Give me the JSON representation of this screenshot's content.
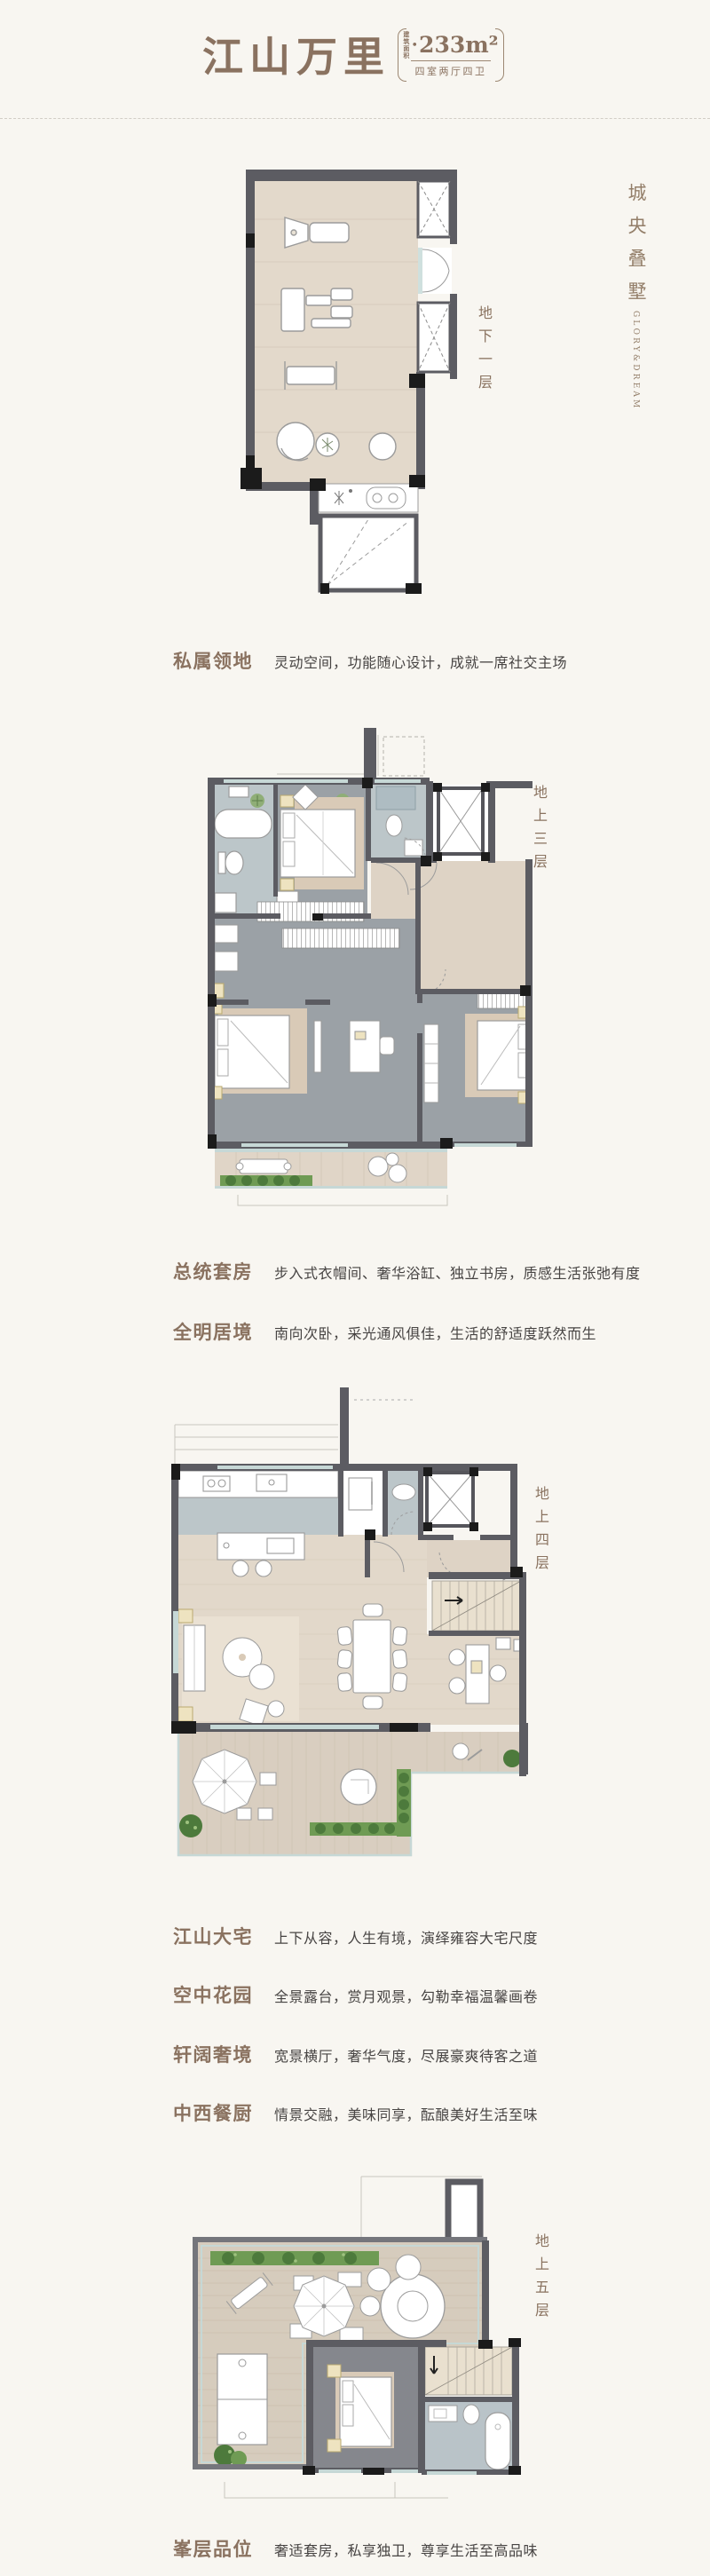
{
  "page": {
    "background": "#f8f6f1"
  },
  "header": {
    "title": "江山万里",
    "area_label_lines": [
      "建筑",
      "面积"
    ],
    "area_bullet": "•",
    "area_value": "233m²",
    "layout": "四室两厅四卫"
  },
  "brand": {
    "cn": "城央叠墅",
    "en": "GLORY&DREAM"
  },
  "floors": [
    {
      "id": "basement",
      "label": "地下一层"
    },
    {
      "id": "floor-3",
      "label": "地上三层"
    },
    {
      "id": "floor-4",
      "label": "地上四层"
    },
    {
      "id": "floor-5",
      "label": "地上五层"
    }
  ],
  "features": [
    {
      "title": "私属领地",
      "desc": "灵动空间，功能随心设计，成就一席社交主场"
    },
    {
      "title": "总统套房",
      "desc": "步入式衣帽间、奢华浴缸、独立书房，质感生活张弛有度"
    },
    {
      "title": "全明居境",
      "desc": "南向次卧，采光通风俱佳，生活的舒适度跃然而生"
    },
    {
      "title": "江山大宅",
      "desc": "上下从容，人生有境，演绎雍容大宅尺度"
    },
    {
      "title": "空中花园",
      "desc": "全景露台，赏月观景，勾勒幸福温馨画卷"
    },
    {
      "title": "轩阔奢境",
      "desc": "宽景横厅，奢华气度，尽展豪爽待客之道"
    },
    {
      "title": "中西餐厨",
      "desc": "情景交融，美味同享，酝酿美好生活至味"
    },
    {
      "title": "峯层品位",
      "desc": "奢适套房，私享独卫，尊享生活至高品味"
    }
  ],
  "colors": {
    "accent_brown": "#8a7260",
    "text_dark": "#474443",
    "wall_gray": "#5c5c62",
    "wall_black": "#1b1b1b",
    "floor_beige": "#e0d6c8",
    "bath_blue": "#bcc6c9",
    "terrace_green": "#6f9b54",
    "window_teal": "#c6d8d6"
  }
}
